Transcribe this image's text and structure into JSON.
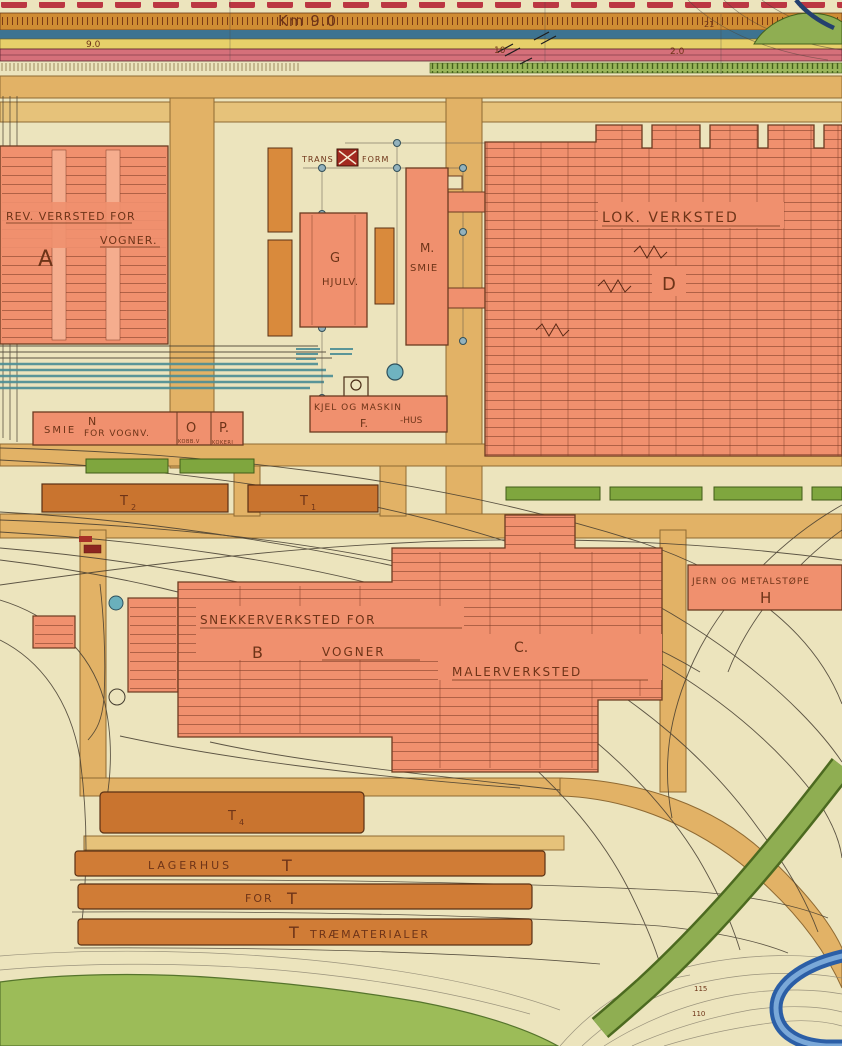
{
  "colors": {
    "paper": "#ece4bd",
    "building_salmon": "#f0906e",
    "building_dark_orange": "#cd7a33",
    "road_ochre": "#e2b266",
    "grass_green": "#8fae52",
    "track_teal": "#4b8d95",
    "river_blue": "#2b5ea6",
    "red_dash_band": "#bb3742",
    "ruler_orange": "#cf8c33",
    "band_blue": "#3d7391",
    "band_yellow": "#e7d06a",
    "band_pink": "#d5707a"
  },
  "top_strip": {
    "km_label": "Km 9.0",
    "chainage": {
      "left": "9.0",
      "mid": "10",
      "right": "2.0",
      "corner": "21"
    }
  },
  "buildings": {
    "a": {
      "letter": "A",
      "line1": "REV. VERRSTED FOR",
      "line2": "VOGNER."
    },
    "g": {
      "letter": "G",
      "name": "HJULV."
    },
    "m": {
      "letter": "M.",
      "name": "SMIE"
    },
    "d": {
      "letter": "D",
      "name": "LOK. VERKSTED"
    },
    "f": {
      "letter": "F.",
      "line1": "KJEL OG MASKIN",
      "line2": "-HUS"
    },
    "transformer": {
      "left": "TRANS",
      "right": "FORM"
    },
    "n": {
      "letter": "N",
      "line1": "SMIE",
      "line2": "FOR VOGNV."
    },
    "o": {
      "letter": "O",
      "sub": "KOBB.V"
    },
    "p": {
      "letter": "P.",
      "sub": "KOKERI"
    },
    "t2": {
      "base": "T",
      "sub": "2"
    },
    "t1": {
      "base": "T",
      "sub": "1"
    },
    "t4": {
      "base": "T",
      "sub": "4"
    },
    "h": {
      "letter": "H",
      "name": "JERN OG METALSTØPE"
    },
    "b": {
      "letter": "B",
      "line1": "SNEKKERVERKSTED FOR",
      "line2": "VOGNER"
    },
    "c": {
      "letter": "C.",
      "name": "MALERVERKSTED"
    },
    "s1": {
      "name": "LAGERHUS",
      "mark": "T"
    },
    "s2": {
      "name": "FOR",
      "mark": "T"
    },
    "s3": {
      "mark": "T",
      "name": "TRÆMATERIALER"
    }
  },
  "contour_labels": {
    "upper": "115",
    "lower": "110"
  }
}
